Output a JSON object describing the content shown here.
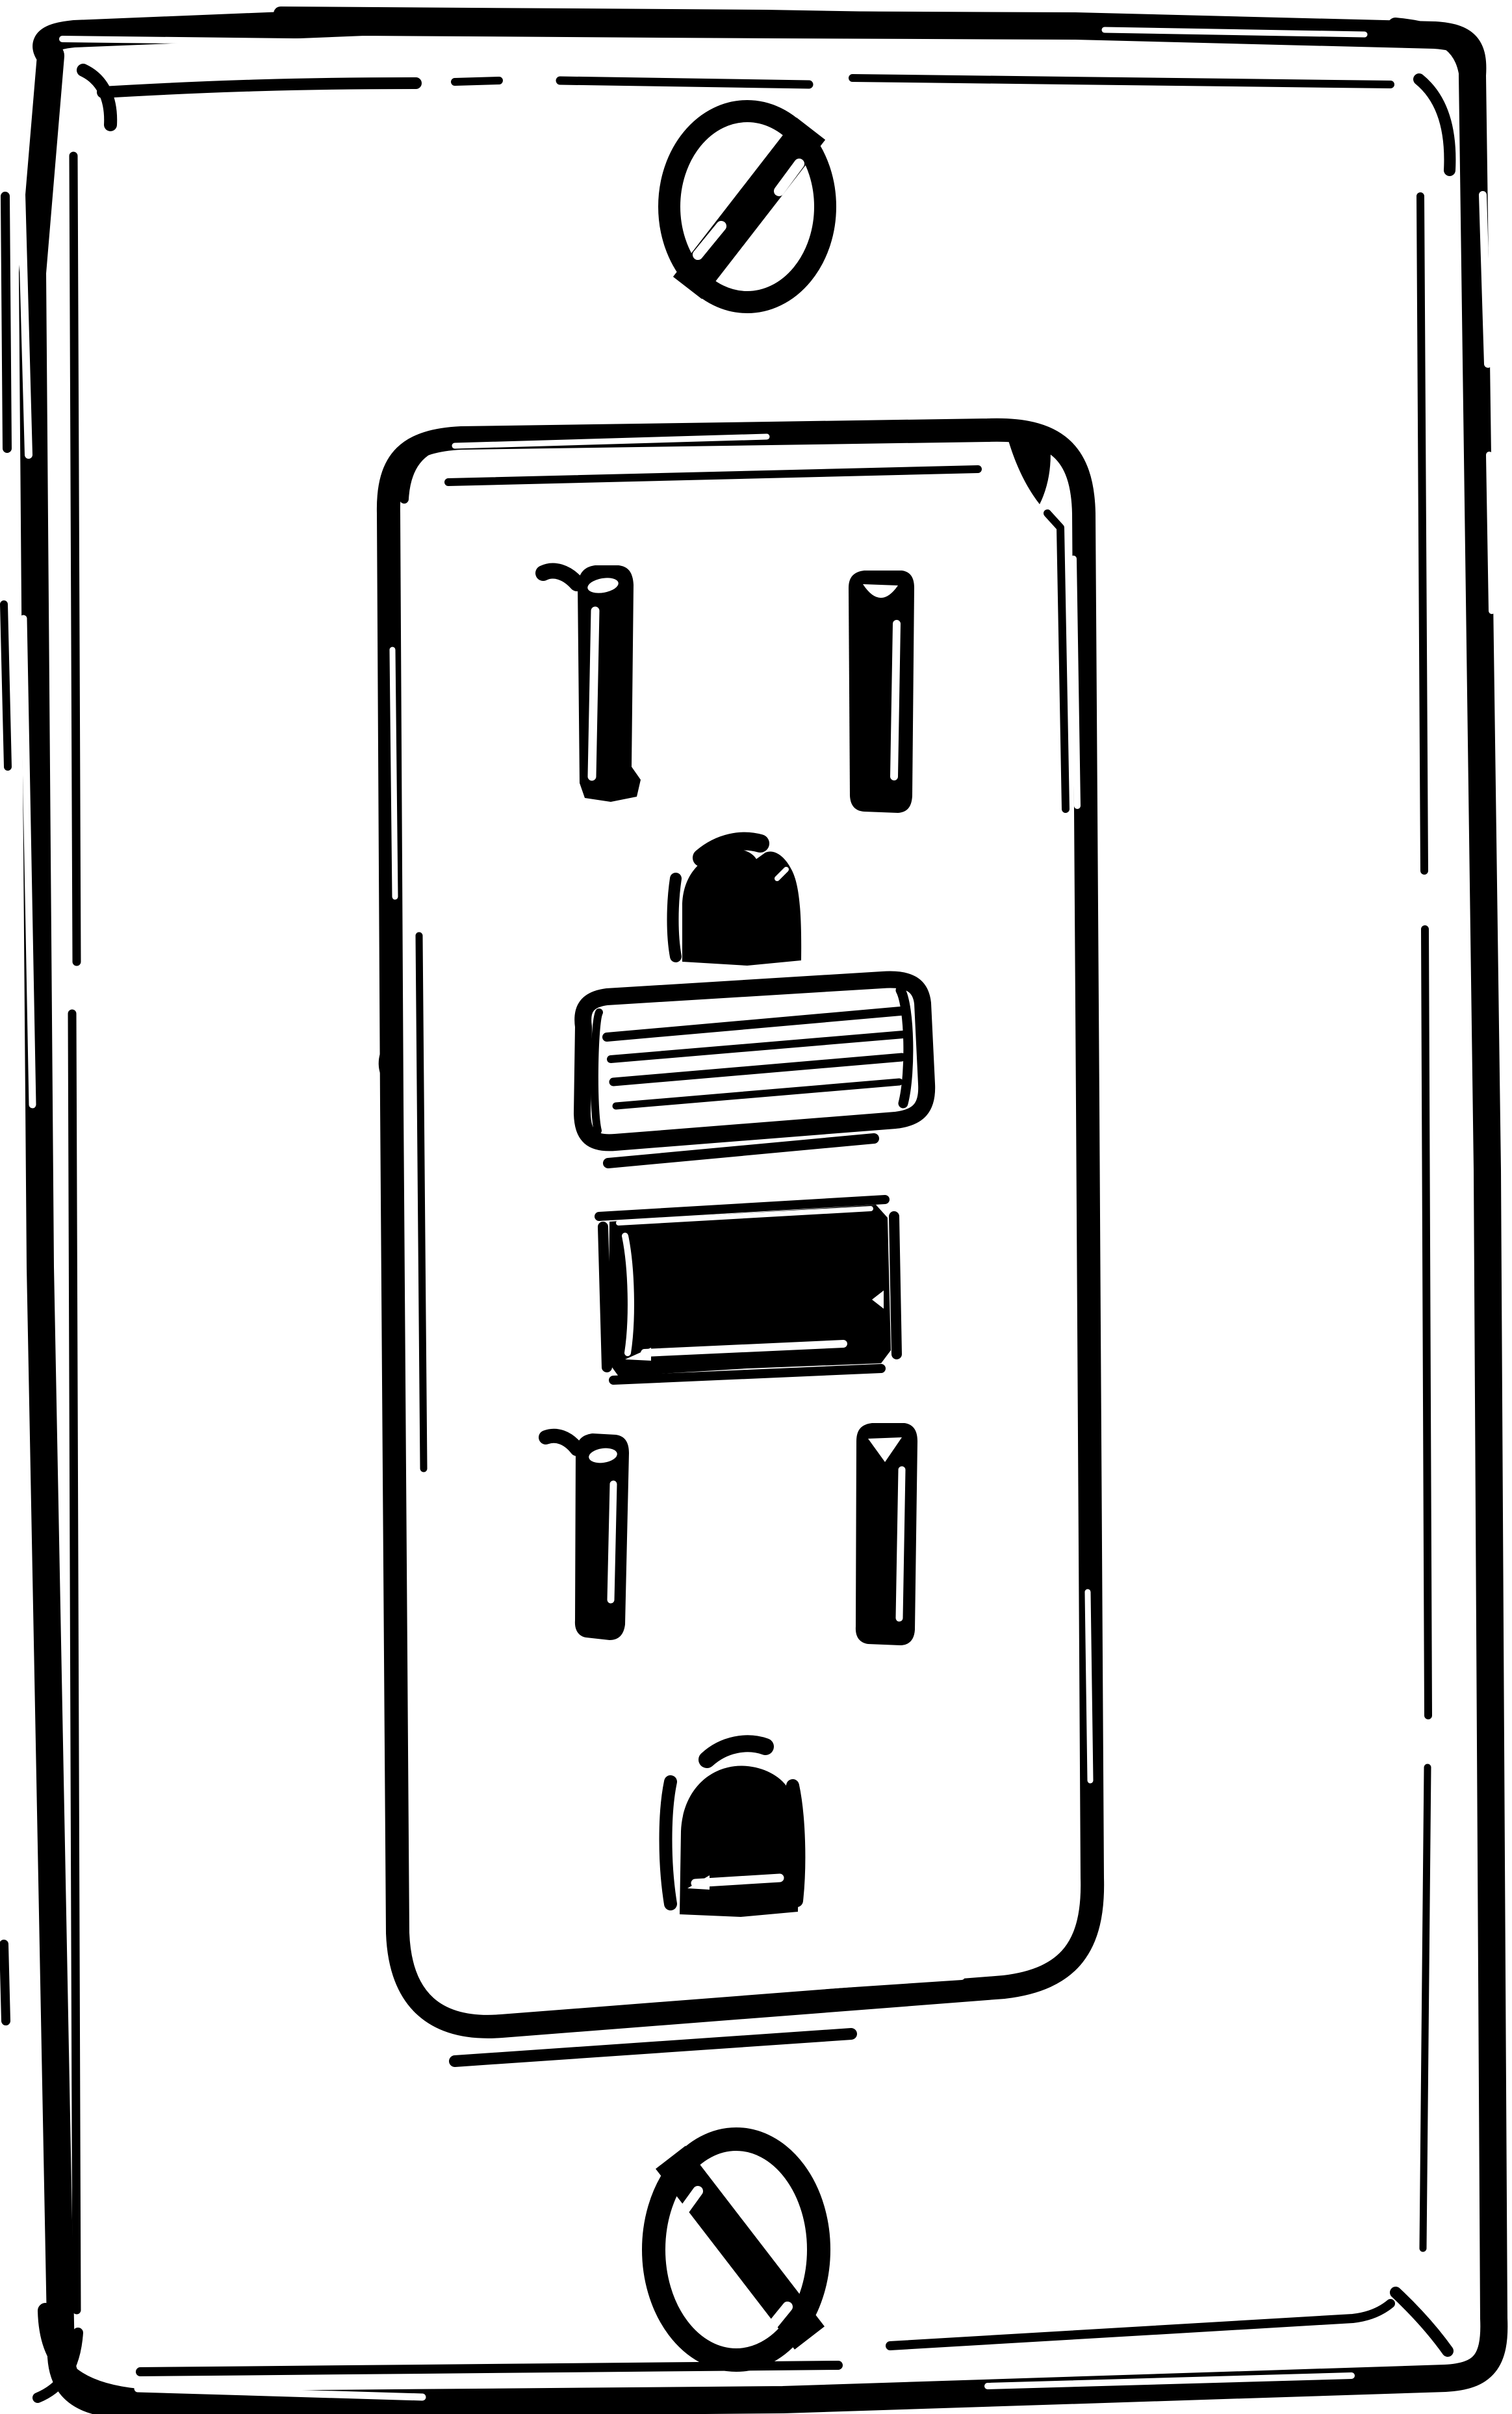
{
  "illustration": {
    "description": "Hand-drawn black ink sketch of a decora-style GFCI electrical wall outlet: a rectangular wall plate with top and bottom mounting screws, a central receptacle face containing two three-prong sockets, and a ribbed reset button with a solid black test button between them.",
    "colors": {
      "ink": "#000000",
      "paper": "#ffffff"
    },
    "parts": {
      "wall_plate": "wall plate",
      "plate_inner_line": "plate inner outline",
      "top_screw": "top mounting screw",
      "bottom_screw": "bottom mounting screw",
      "outlet_face": "receptacle face",
      "top_receptacle": "upper socket",
      "bottom_receptacle": "lower socket",
      "neutral_slot": "neutral prong slot",
      "hot_slot": "hot prong slot",
      "ground_hole": "ground pin hole",
      "reset_button": "reset button (ribbed)",
      "test_button": "test button (solid)"
    }
  }
}
